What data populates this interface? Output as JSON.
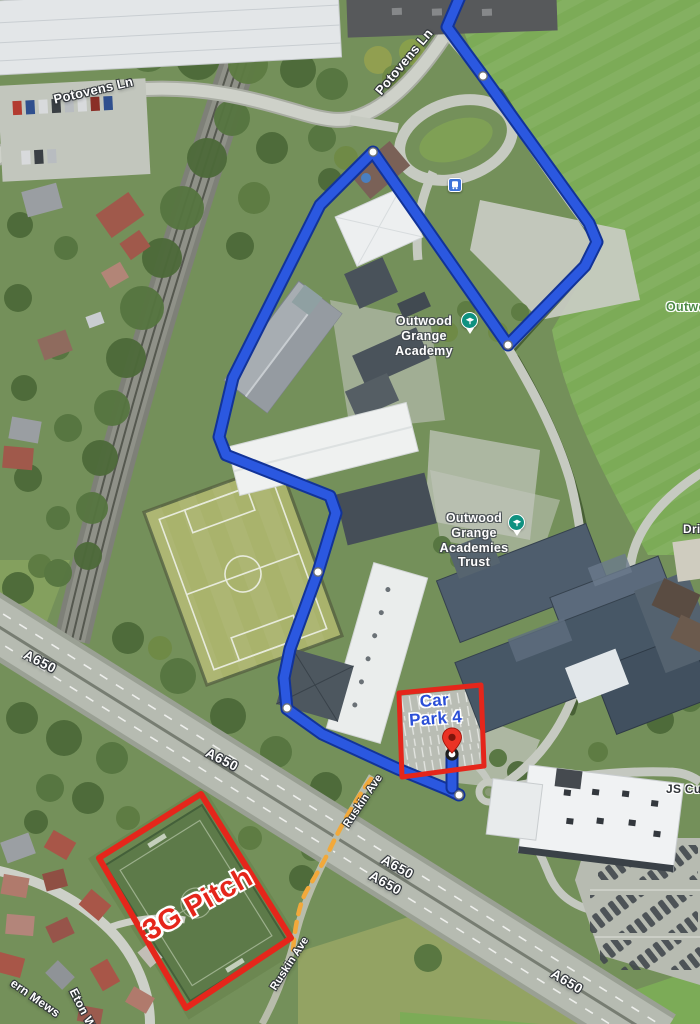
{
  "map": {
    "kind": "satellite-map-with-route-and-annotations",
    "labels": {
      "potovens_ln_a": "Potovens Ln",
      "potovens_ln_b": "Potovens Ln",
      "academy": "Outwood Grange Academy",
      "trust": "Outwood Grange Academies Trust",
      "outwood_area_clipped": "Outwoo",
      "drive_clipped": "Driv",
      "js_cur_clipped": "JS Cur",
      "a650_1": "A650",
      "a650_2": "A650",
      "a650_3": "A650",
      "a650_4": "A650",
      "a650_5": "A650",
      "ruskin_ave_a": "Ruskin Ave",
      "ruskin_ave_b": "Ruskin Ave",
      "ern_mews_clipped": "ern Mews",
      "eton_w_clipped": "Eton W",
      "car_park_4": "Car Park 4",
      "pitch_3g": "3G Pitch"
    },
    "icons": {
      "bus_stop": "bus-icon",
      "school_poi_pin": "graduation-cap-pin",
      "destination_pin": "red-map-pin",
      "route_waypoint": "white-dot",
      "route_end": "ringed-circle"
    },
    "colors": {
      "route_blue": "#2b58e0",
      "route_casing": "#123398",
      "annotation_red": "#e5261b",
      "car_park_text_blue": "#2b4fd7",
      "area_label_green": "#4c8a45",
      "poi_pin_teal": "#0f9180",
      "footpath_orange": "#f2a93b"
    }
  }
}
